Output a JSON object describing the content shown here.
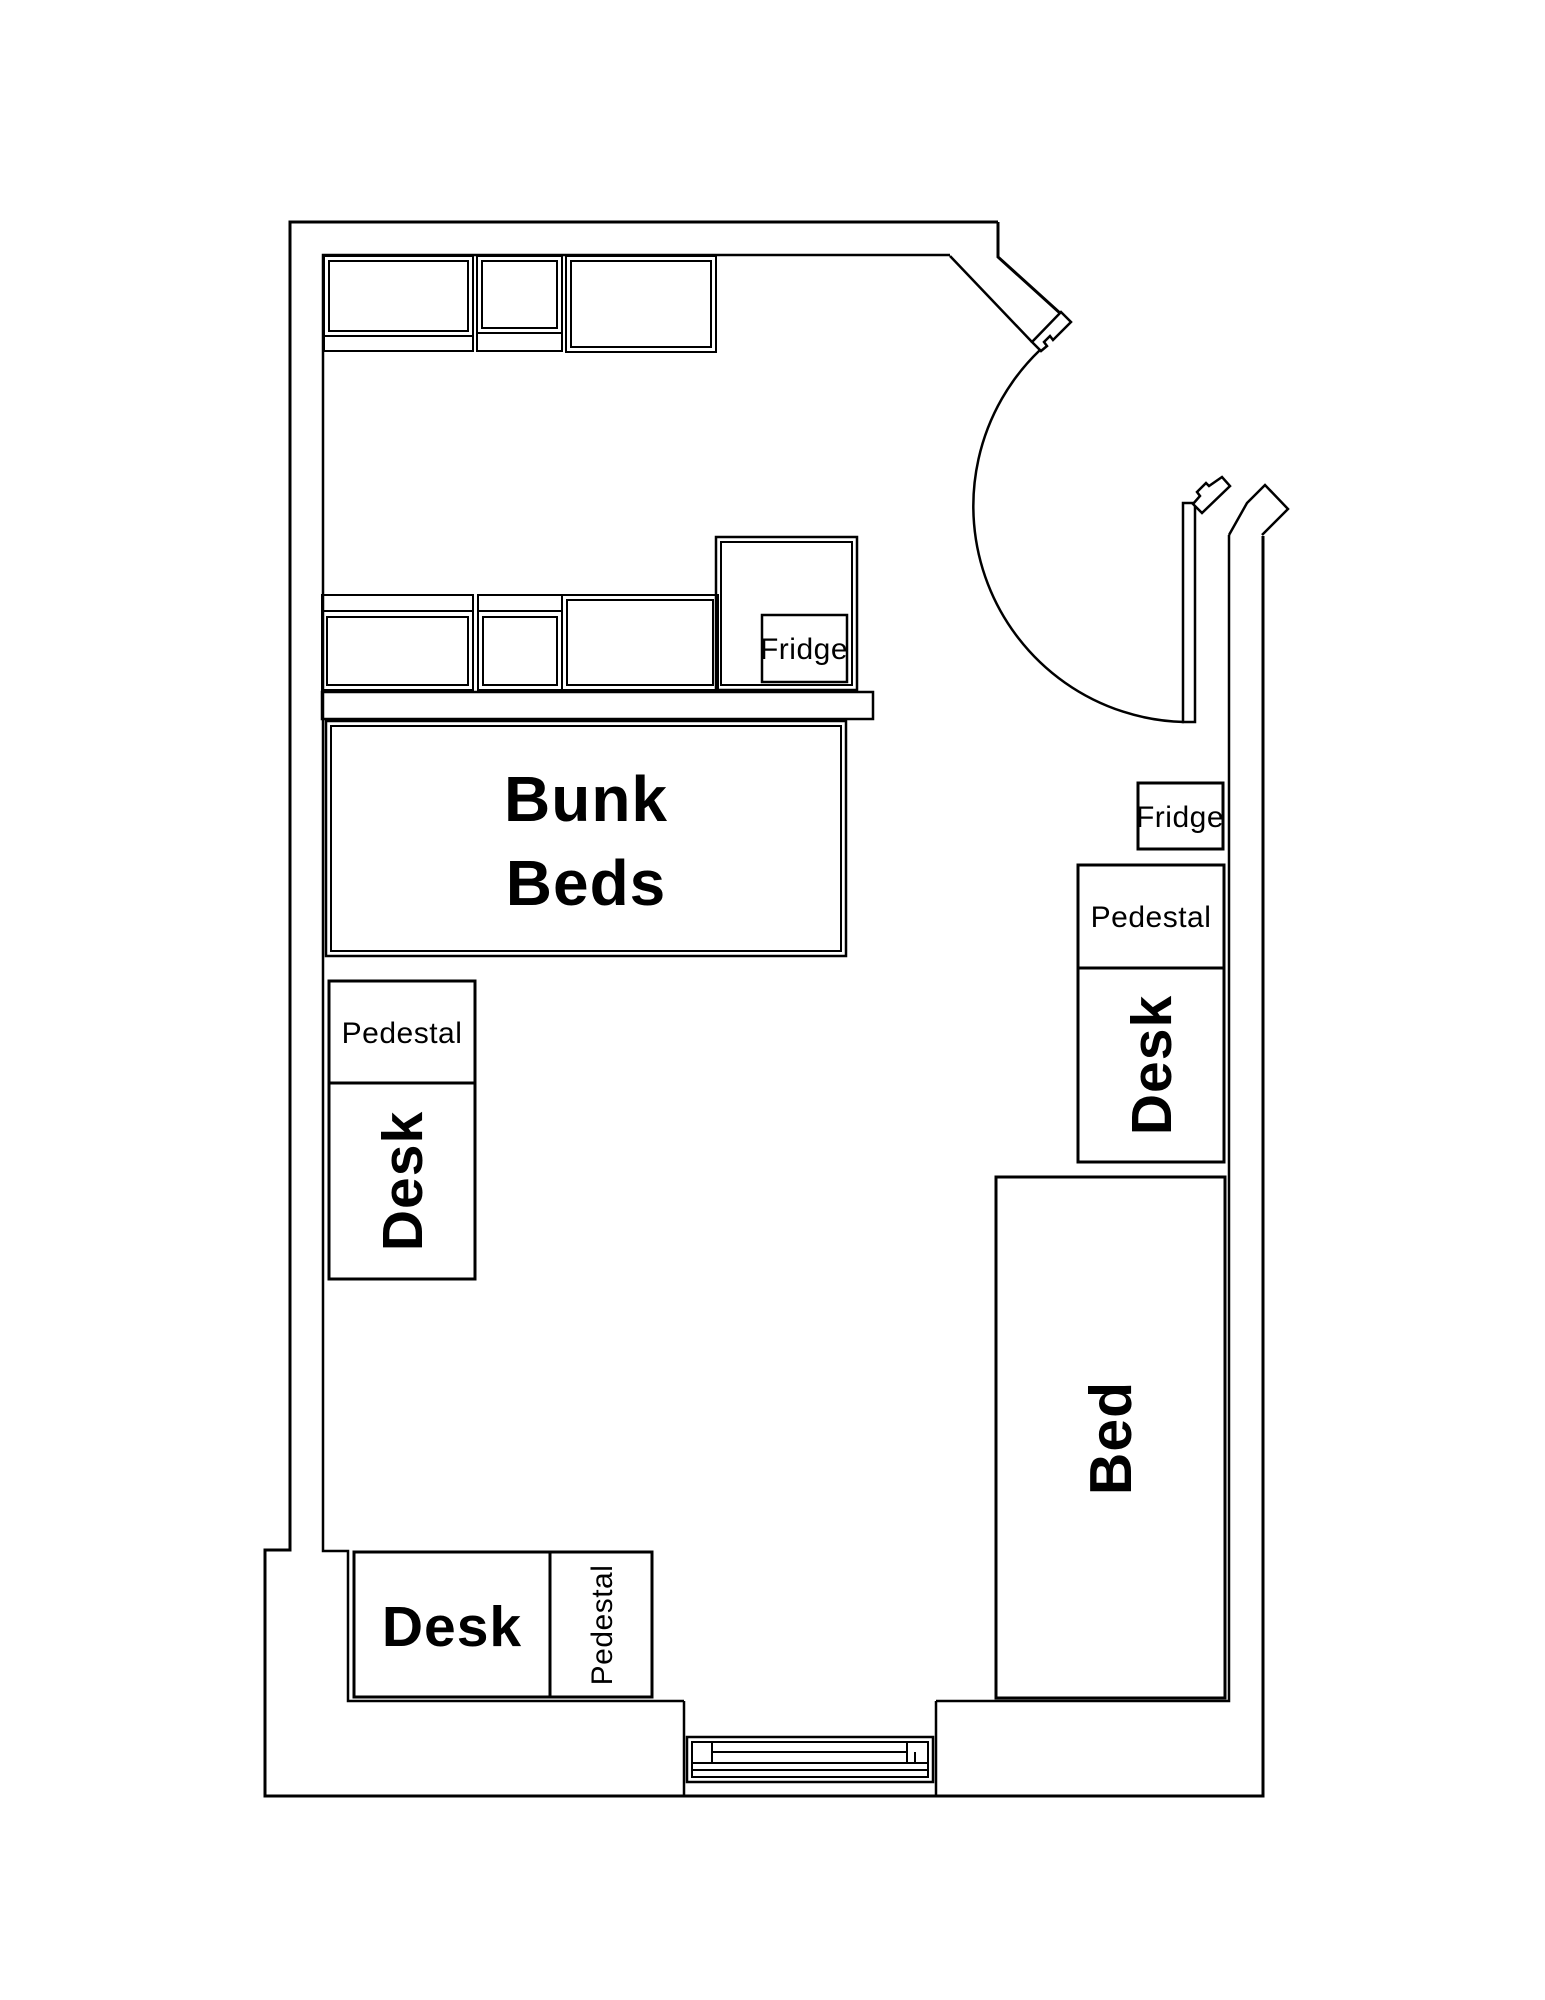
{
  "document": {
    "type": "floor-plan",
    "background_color": "#ffffff",
    "line_color": "#000000"
  },
  "labels": {
    "bunk_beds_line1": "Bunk",
    "bunk_beds_line2": "Beds",
    "fridge_closet": "Fridge",
    "fridge_right": "Fridge",
    "pedestal_left": "Pedestal",
    "desk_left": "Desk",
    "pedestal_right": "Pedestal",
    "desk_right": "Desk",
    "bed": "Bed",
    "desk_bottom": "Desk",
    "pedestal_bottom": "Pedestal"
  }
}
